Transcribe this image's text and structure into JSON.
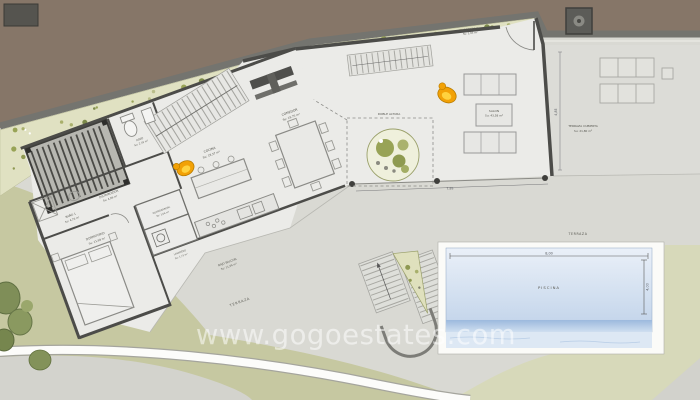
{
  "watermark": "www.gogoestates.com",
  "rooms": {
    "salon": {
      "name": "SALON",
      "area": "Su: 43,58 m²"
    },
    "comedor": {
      "name": "COMEDOR",
      "area": "Su: 19,75 m²"
    },
    "cocina": {
      "name": "COCINA",
      "area": "Su: 18,37 m²"
    },
    "aseo": {
      "name": "ASEO",
      "area": "Su: 2,35 m²"
    },
    "bano1": {
      "name": "BAÑO 1",
      "area": "Su: 4,76 m²"
    },
    "dormitorio": {
      "name": "DORMITORIO",
      "area": "Su: 11,69 m²"
    },
    "distribuidor": {
      "name": "DISTRIBUIDOR",
      "area": "Su: 4,96 m²"
    },
    "guardarropa": {
      "name": "GUARDARROPA",
      "area": "Su: 1,06 m²"
    },
    "lavadero": {
      "name": "LAVADERO",
      "area": "Su: 1,71 m²"
    },
    "doble_altura": {
      "name": "DOBLE ALTURA"
    },
    "terraza_cubierta": {
      "name": "TERRAZA CUBIERTA",
      "area": "Su: 21,80 m²"
    },
    "bajo_balcon": {
      "name": "BAJO BALCON",
      "area": "Su: 11,64 m²"
    },
    "jardinera": {
      "name": "JARDINERA 2",
      "area": "Su: 1,95 m²"
    },
    "piscina": {
      "name": "PISCINA"
    },
    "terraza_upper": {
      "name": "TERRAZA"
    },
    "terraza_lower": {
      "name": "TERRAZA"
    }
  },
  "dimensions": {
    "pool_width": "8,00",
    "pool_height": "4,00",
    "salon_width": "7,85",
    "salon_height": "4,85"
  },
  "colors": {
    "road_brown": "#867668",
    "retaining_wall": "#74746f",
    "planter_strip": "#e0e1c2",
    "wall_dark": "#4c4c49",
    "floor_interior": "#ebebe8",
    "terrace_gray": "#dcdcd7",
    "terrain_olive": "#c6c8a1",
    "terrain_pale_green": "#d7d9ba",
    "pool_water_light": "#e9eff8",
    "pool_water_dark": "#c5d5ea",
    "accent_orange": "#f2a106"
  }
}
